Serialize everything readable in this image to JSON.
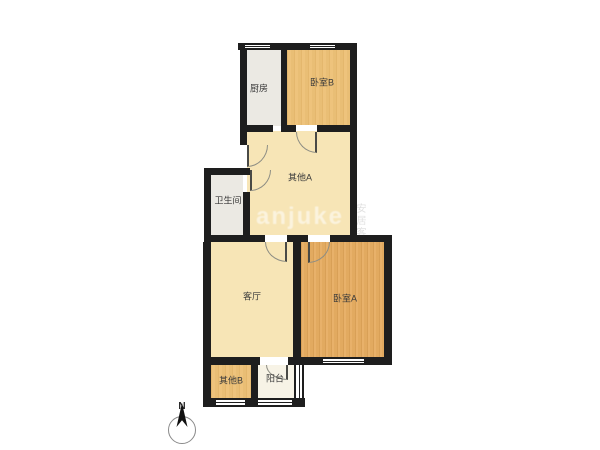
{
  "floor_plan": {
    "rooms": {
      "kitchen": {
        "label": "厨房"
      },
      "bedroom_b": {
        "label": "卧室B"
      },
      "other_a": {
        "label": "其他A"
      },
      "bathroom": {
        "label": "卫生间"
      },
      "living_room": {
        "label": "客厅"
      },
      "bedroom_a": {
        "label": "卧室A"
      },
      "other_b": {
        "label": "其他B"
      },
      "balcony": {
        "label": "阳台"
      }
    },
    "compass": {
      "label": "N"
    },
    "watermark": {
      "text": "anjuke",
      "logo_side_text": "安居客"
    },
    "colors": {
      "wall": "#1e1e1e",
      "bedroom": "#e7ad62",
      "bedroom_light": "#edc177",
      "cream": "#f7e5b6",
      "gray_room": "#ebe9e3",
      "balcony": "#f7f3e6",
      "door_arc": "#8d8d84",
      "label_text": "#3a3a3a"
    }
  }
}
